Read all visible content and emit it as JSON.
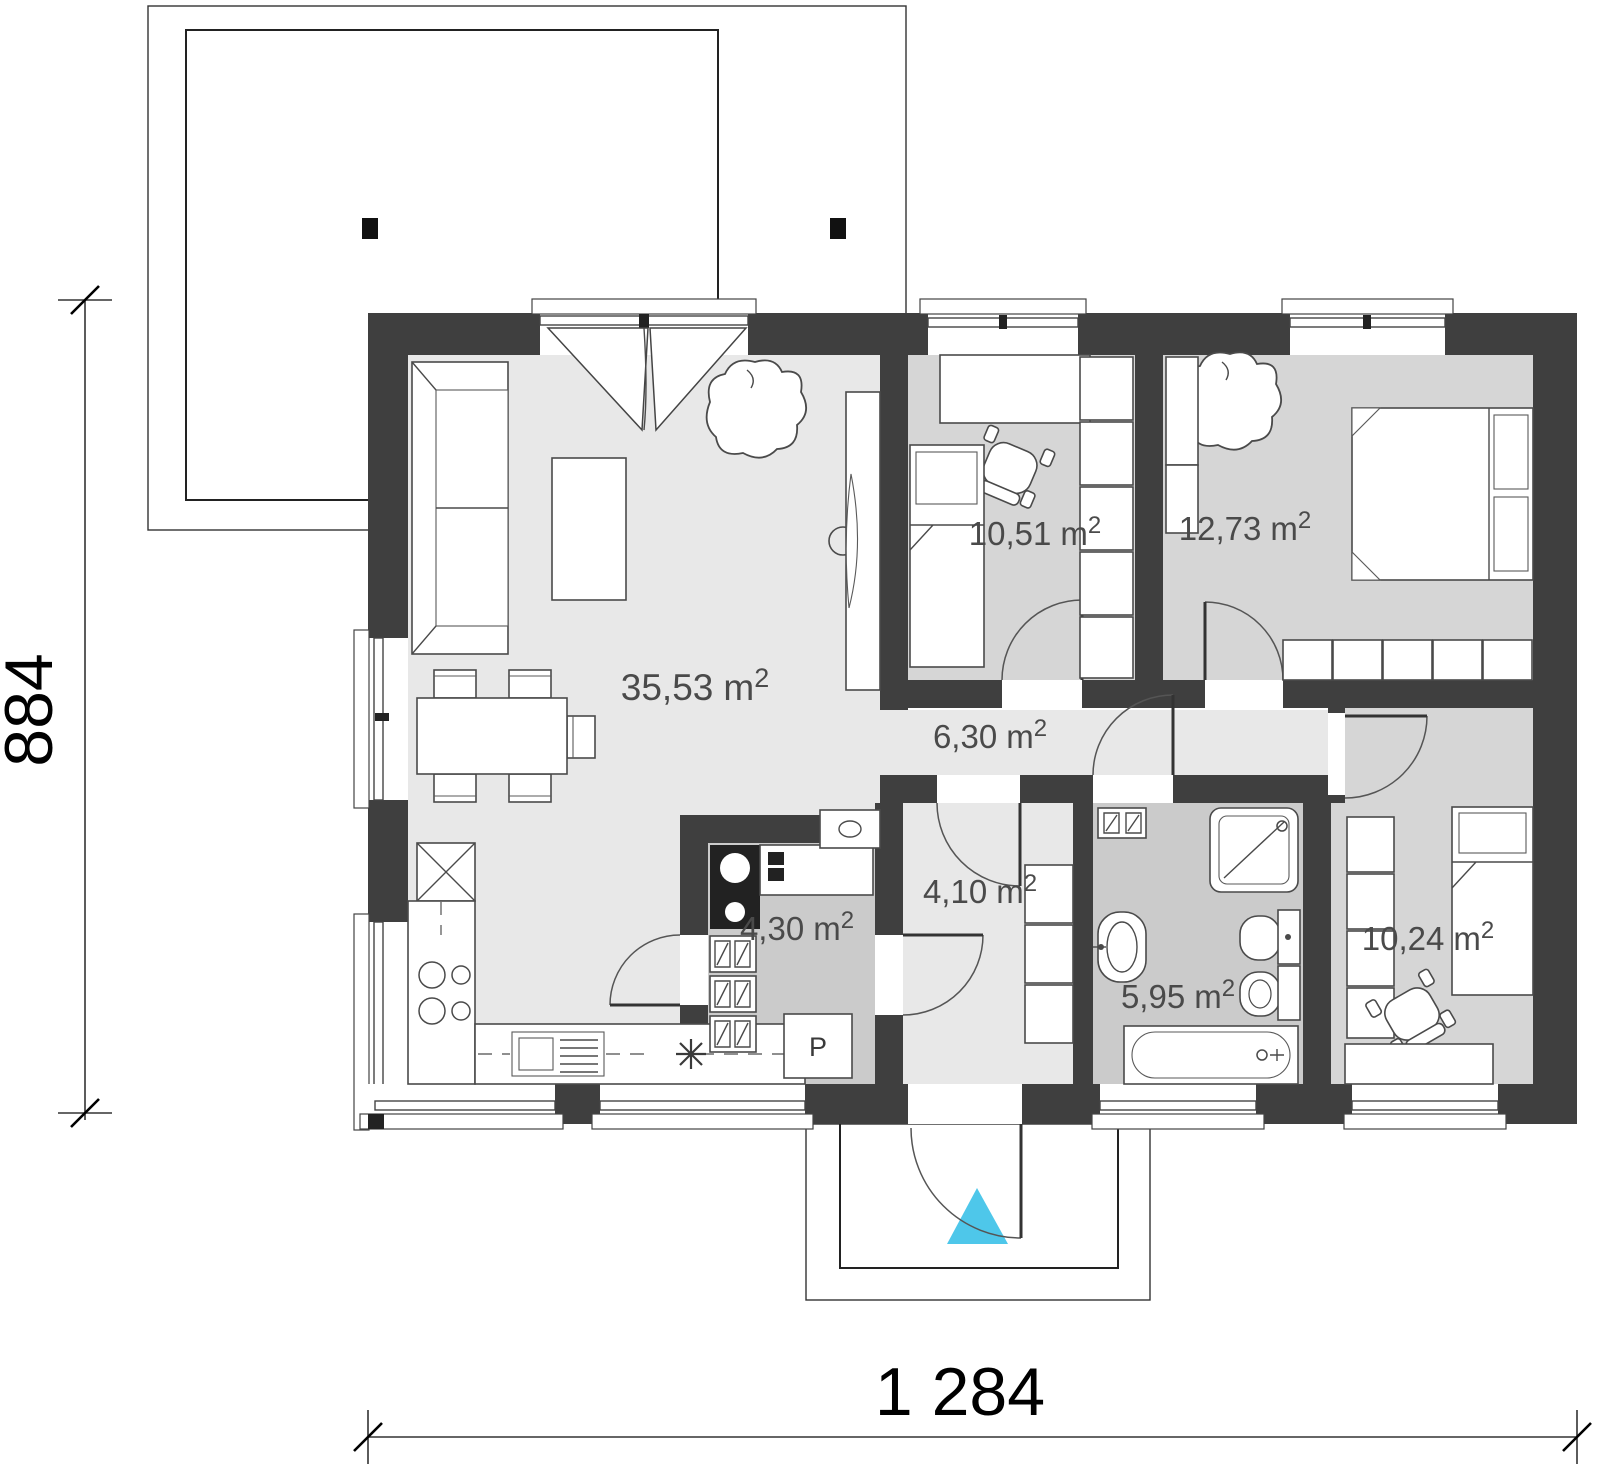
{
  "drawing_type": "house-floor-plan",
  "dimensions": {
    "width_label": "1 284",
    "height_label": "884"
  },
  "rooms": [
    {
      "id": "living-room",
      "area": "35,53",
      "unit": "m",
      "sup": "2"
    },
    {
      "id": "bedroom-1",
      "area": "10,51",
      "unit": "m",
      "sup": "2"
    },
    {
      "id": "bedroom-2",
      "area": "12,73",
      "unit": "m",
      "sup": "2"
    },
    {
      "id": "hallway",
      "area": "6,30",
      "unit": "m",
      "sup": "2"
    },
    {
      "id": "entry",
      "area": "4,10",
      "unit": "m",
      "sup": "2"
    },
    {
      "id": "pantry",
      "area": "4,30",
      "unit": "m",
      "sup": "2"
    },
    {
      "id": "bathroom",
      "area": "5,95",
      "unit": "m",
      "sup": "2"
    },
    {
      "id": "bedroom-3",
      "area": "10,24",
      "unit": "m",
      "sup": "2"
    }
  ],
  "markers": {
    "pantry_label": "P"
  },
  "colors": {
    "wall": "#3f3f3f",
    "floor_light": "#e8e8e8",
    "floor_bedroom": "#d6d6d6",
    "floor_service": "#cbcbcb",
    "entrance_marker": "#4ec7ea"
  }
}
